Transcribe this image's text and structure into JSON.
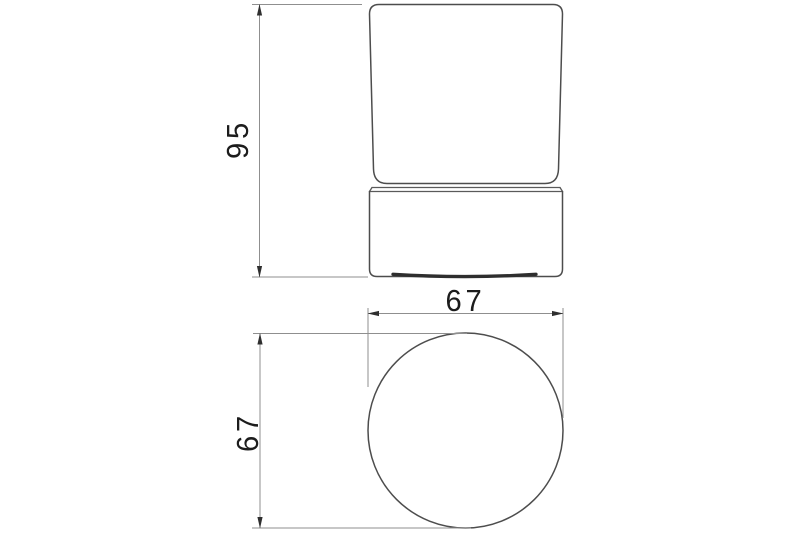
{
  "drawing": {
    "title": "tumbler-holder-technical-drawing",
    "background_color": "#ffffff",
    "object_line_color": "#4d4d4d",
    "dimension_line_color": "#8f8f8f",
    "arrow_color": "#2f2f2f",
    "text_color": "#1c1c1c",
    "views": {
      "front": {
        "name": "front-elevation-tumbler-in-holder"
      },
      "top": {
        "name": "top-plan-circle"
      }
    },
    "dimensions": {
      "front_height": {
        "value": "95",
        "orientation": "vertical"
      },
      "top_width": {
        "value": "67",
        "orientation": "horizontal"
      },
      "top_depth": {
        "value": "67",
        "orientation": "vertical"
      }
    }
  }
}
